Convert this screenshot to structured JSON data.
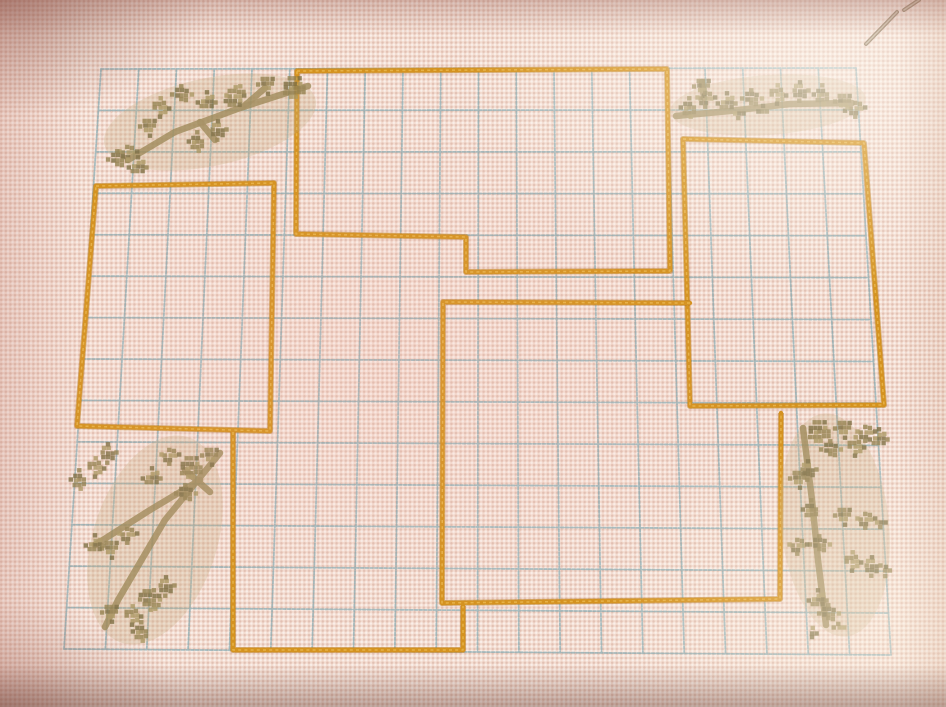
{
  "meta": {
    "scene": "Photograph of a hand-embroidered cross-stitch sampler on pale pink Aida fabric",
    "contents": "light blue stitched grid, five overlapping orange rectangle frames, four olive-green branch-and-leaf motifs in the corners, sewing needle resting at top right edge",
    "visible_text": ""
  },
  "canvas": {
    "width": 946,
    "height": 707
  },
  "palette": {
    "fabric": "#f3dcd0",
    "grid_blue": "#76a3ad",
    "stitch_orange": "#d4921f",
    "stitch_orange_dark": "#b4761a",
    "stitch_orange_light": "#eebc55",
    "motif_olive": "#93814e",
    "motif_olive_dark": "#7c6d41",
    "motif_olive_light": "#a99560",
    "motif_stem": "#a18c5c",
    "motif_haze": "#c8ad84",
    "needle": "#8d7358",
    "needle_light": "#cfc0a8"
  },
  "grid": {
    "corners": {
      "tl": [
        101,
        69
      ],
      "tr": [
        856,
        68
      ],
      "br": [
        891,
        655
      ],
      "bl": [
        64,
        649
      ]
    },
    "cols": 20,
    "rows": 14,
    "stroke_width": 1.8,
    "dash": "3 1.7",
    "opacity": 0.62
  },
  "frames": [
    {
      "name": "frame-top-banner",
      "closed": true,
      "points": [
        [
          297,
          71
        ],
        [
          667,
          69
        ],
        [
          670,
          271
        ],
        [
          466,
          272
        ],
        [
          466,
          237
        ],
        [
          296,
          234
        ]
      ]
    },
    {
      "name": "frame-top-left",
      "closed": true,
      "points": [
        [
          96,
          186
        ],
        [
          274,
          183
        ],
        [
          270,
          431
        ],
        [
          77,
          426
        ]
      ]
    },
    {
      "name": "frame-top-right",
      "closed": true,
      "points": [
        [
          683,
          139
        ],
        [
          864,
          143
        ],
        [
          884,
          405
        ],
        [
          690,
          406
        ]
      ]
    },
    {
      "name": "frame-center",
      "closed": false,
      "points": [
        [
          690,
          303
        ],
        [
          443,
          302
        ],
        [
          442,
          603
        ],
        [
          780,
          599
        ],
        [
          781,
          413
        ]
      ]
    },
    {
      "name": "frame-bottom-left",
      "closed": false,
      "points": [
        [
          233,
          432
        ],
        [
          233,
          650
        ],
        [
          463,
          650
        ],
        [
          463,
          606
        ]
      ]
    }
  ],
  "motifs": [
    {
      "name": "branch-motif-top-left",
      "haze": {
        "cx": 210,
        "cy": 122,
        "rx": 108,
        "ry": 44,
        "rot": -12
      },
      "stems": [
        [
          [
            308,
            86
          ],
          [
            240,
            108
          ],
          [
            175,
            132
          ],
          [
            128,
            160
          ]
        ],
        [
          [
            243,
            107
          ],
          [
            265,
            88
          ]
        ],
        [
          [
            200,
            122
          ],
          [
            215,
            140
          ]
        ]
      ],
      "leaves": [
        [
          295,
          88,
          12
        ],
        [
          268,
          84,
          10
        ],
        [
          235,
          96,
          13
        ],
        [
          207,
          102,
          10
        ],
        [
          182,
          95,
          10
        ],
        [
          160,
          108,
          9
        ],
        [
          218,
          130,
          9
        ],
        [
          198,
          142,
          8
        ],
        [
          150,
          126,
          8
        ],
        [
          128,
          152,
          10
        ],
        [
          138,
          167,
          8
        ],
        [
          118,
          160,
          7
        ]
      ]
    },
    {
      "name": "branch-motif-top-right",
      "haze": {
        "cx": 768,
        "cy": 105,
        "rx": 98,
        "ry": 30,
        "rot": -4
      },
      "stems": [
        [
          [
            676,
            116
          ],
          [
            730,
            111
          ],
          [
            790,
            104
          ],
          [
            852,
            103
          ]
        ],
        [
          [
            704,
            98
          ],
          [
            702,
            82
          ]
        ]
      ],
      "leaves": [
        [
          690,
          108,
          8
        ],
        [
          704,
          86,
          8
        ],
        [
          706,
          98,
          7
        ],
        [
          727,
          103,
          8
        ],
        [
          752,
          99,
          9
        ],
        [
          777,
          95,
          9
        ],
        [
          800,
          91,
          9
        ],
        [
          823,
          95,
          9
        ],
        [
          845,
          101,
          9
        ],
        [
          856,
          108,
          8
        ],
        [
          739,
          114,
          6
        ],
        [
          763,
          111,
          6
        ]
      ]
    },
    {
      "name": "branch-motif-bottom-left",
      "haze": {
        "cx": 155,
        "cy": 540,
        "rx": 62,
        "ry": 108,
        "rot": 18
      },
      "stems": [
        [
          [
            220,
            453
          ],
          [
            165,
            520
          ],
          [
            118,
            600
          ],
          [
            105,
            627
          ]
        ],
        [
          [
            200,
            480
          ],
          [
            150,
            510
          ],
          [
            95,
            545
          ]
        ],
        [
          [
            185,
            470
          ],
          [
            210,
            492
          ]
        ]
      ],
      "leaves": [
        [
          192,
          468,
          15
        ],
        [
          212,
          455,
          11
        ],
        [
          170,
          455,
          10
        ],
        [
          152,
          478,
          10
        ],
        [
          186,
          494,
          11
        ],
        [
          95,
          468,
          10
        ],
        [
          108,
          453,
          8
        ],
        [
          80,
          480,
          7
        ],
        [
          112,
          548,
          10
        ],
        [
          128,
          534,
          8
        ],
        [
          95,
          545,
          8
        ],
        [
          150,
          600,
          12
        ],
        [
          132,
          616,
          10
        ],
        [
          166,
          586,
          9
        ],
        [
          142,
          632,
          8
        ],
        [
          112,
          612,
          8
        ]
      ]
    },
    {
      "name": "branch-motif-bottom-right",
      "haze": {
        "cx": 835,
        "cy": 525,
        "rx": 54,
        "ry": 112,
        "rot": -6
      },
      "stems": [
        [
          [
            803,
            428
          ],
          [
            812,
            500
          ],
          [
            818,
            560
          ],
          [
            826,
            625
          ]
        ]
      ],
      "leaves": [
        [
          820,
          432,
          12
        ],
        [
          845,
          428,
          11
        ],
        [
          866,
          432,
          10
        ],
        [
          879,
          439,
          7
        ],
        [
          831,
          450,
          10
        ],
        [
          855,
          447,
          9
        ],
        [
          808,
          470,
          9
        ],
        [
          812,
          510,
          9
        ],
        [
          845,
          515,
          10
        ],
        [
          866,
          519,
          8
        ],
        [
          881,
          523,
          6
        ],
        [
          820,
          545,
          9
        ],
        [
          852,
          562,
          9
        ],
        [
          872,
          566,
          7
        ],
        [
          886,
          571,
          5
        ],
        [
          800,
          478,
          7
        ],
        [
          798,
          545,
          7
        ],
        [
          818,
          600,
          9
        ],
        [
          829,
          614,
          8
        ],
        [
          839,
          628,
          6
        ],
        [
          812,
          633,
          6
        ]
      ]
    }
  ],
  "needle": {
    "segments": [
      [
        [
          866,
          44
        ],
        [
          897,
          12
        ]
      ],
      [
        [
          904,
          10
        ],
        [
          919,
          0
        ]
      ]
    ],
    "width": 4
  }
}
